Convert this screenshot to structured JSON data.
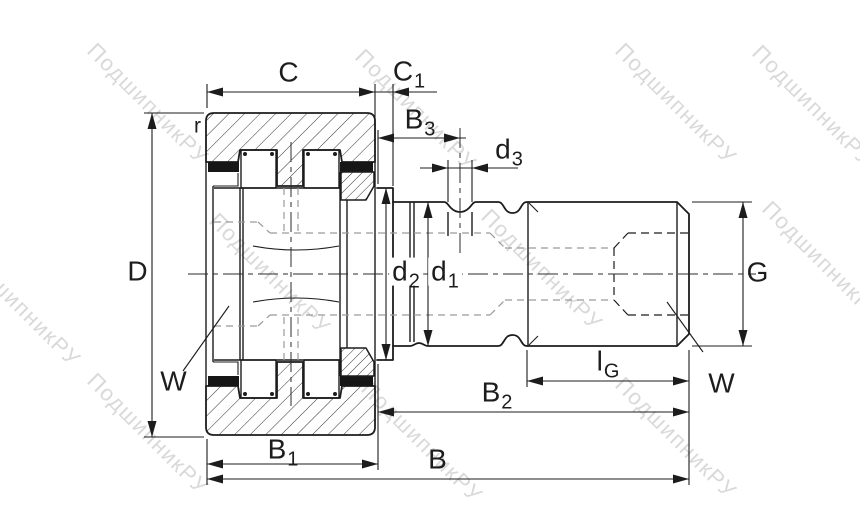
{
  "watermark": {
    "text": "ПодшипникРУ"
  },
  "colors": {
    "line": "#1c1c1c",
    "hidden": "#9a9a9a",
    "watermark": "#c2c2c2",
    "seal": "#161616",
    "background": "#ffffff"
  },
  "labels": {
    "C": {
      "main": "C",
      "sub": ""
    },
    "C1": {
      "main": "C",
      "sub": "1"
    },
    "B3": {
      "main": "B",
      "sub": "3"
    },
    "d3": {
      "main": "d",
      "sub": "3"
    },
    "r": {
      "main": "r",
      "sub": ""
    },
    "D": {
      "main": "D",
      "sub": ""
    },
    "d2": {
      "main": "d",
      "sub": "2"
    },
    "d1": {
      "main": "d",
      "sub": "1"
    },
    "G": {
      "main": "G",
      "sub": ""
    },
    "W_left": {
      "main": "W",
      "sub": ""
    },
    "W_right": {
      "main": "W",
      "sub": ""
    },
    "lG": {
      "main": "l",
      "sub": "G"
    },
    "B2": {
      "main": "B",
      "sub": "2"
    },
    "B1": {
      "main": "B",
      "sub": "1"
    },
    "B": {
      "main": "B",
      "sub": ""
    }
  }
}
